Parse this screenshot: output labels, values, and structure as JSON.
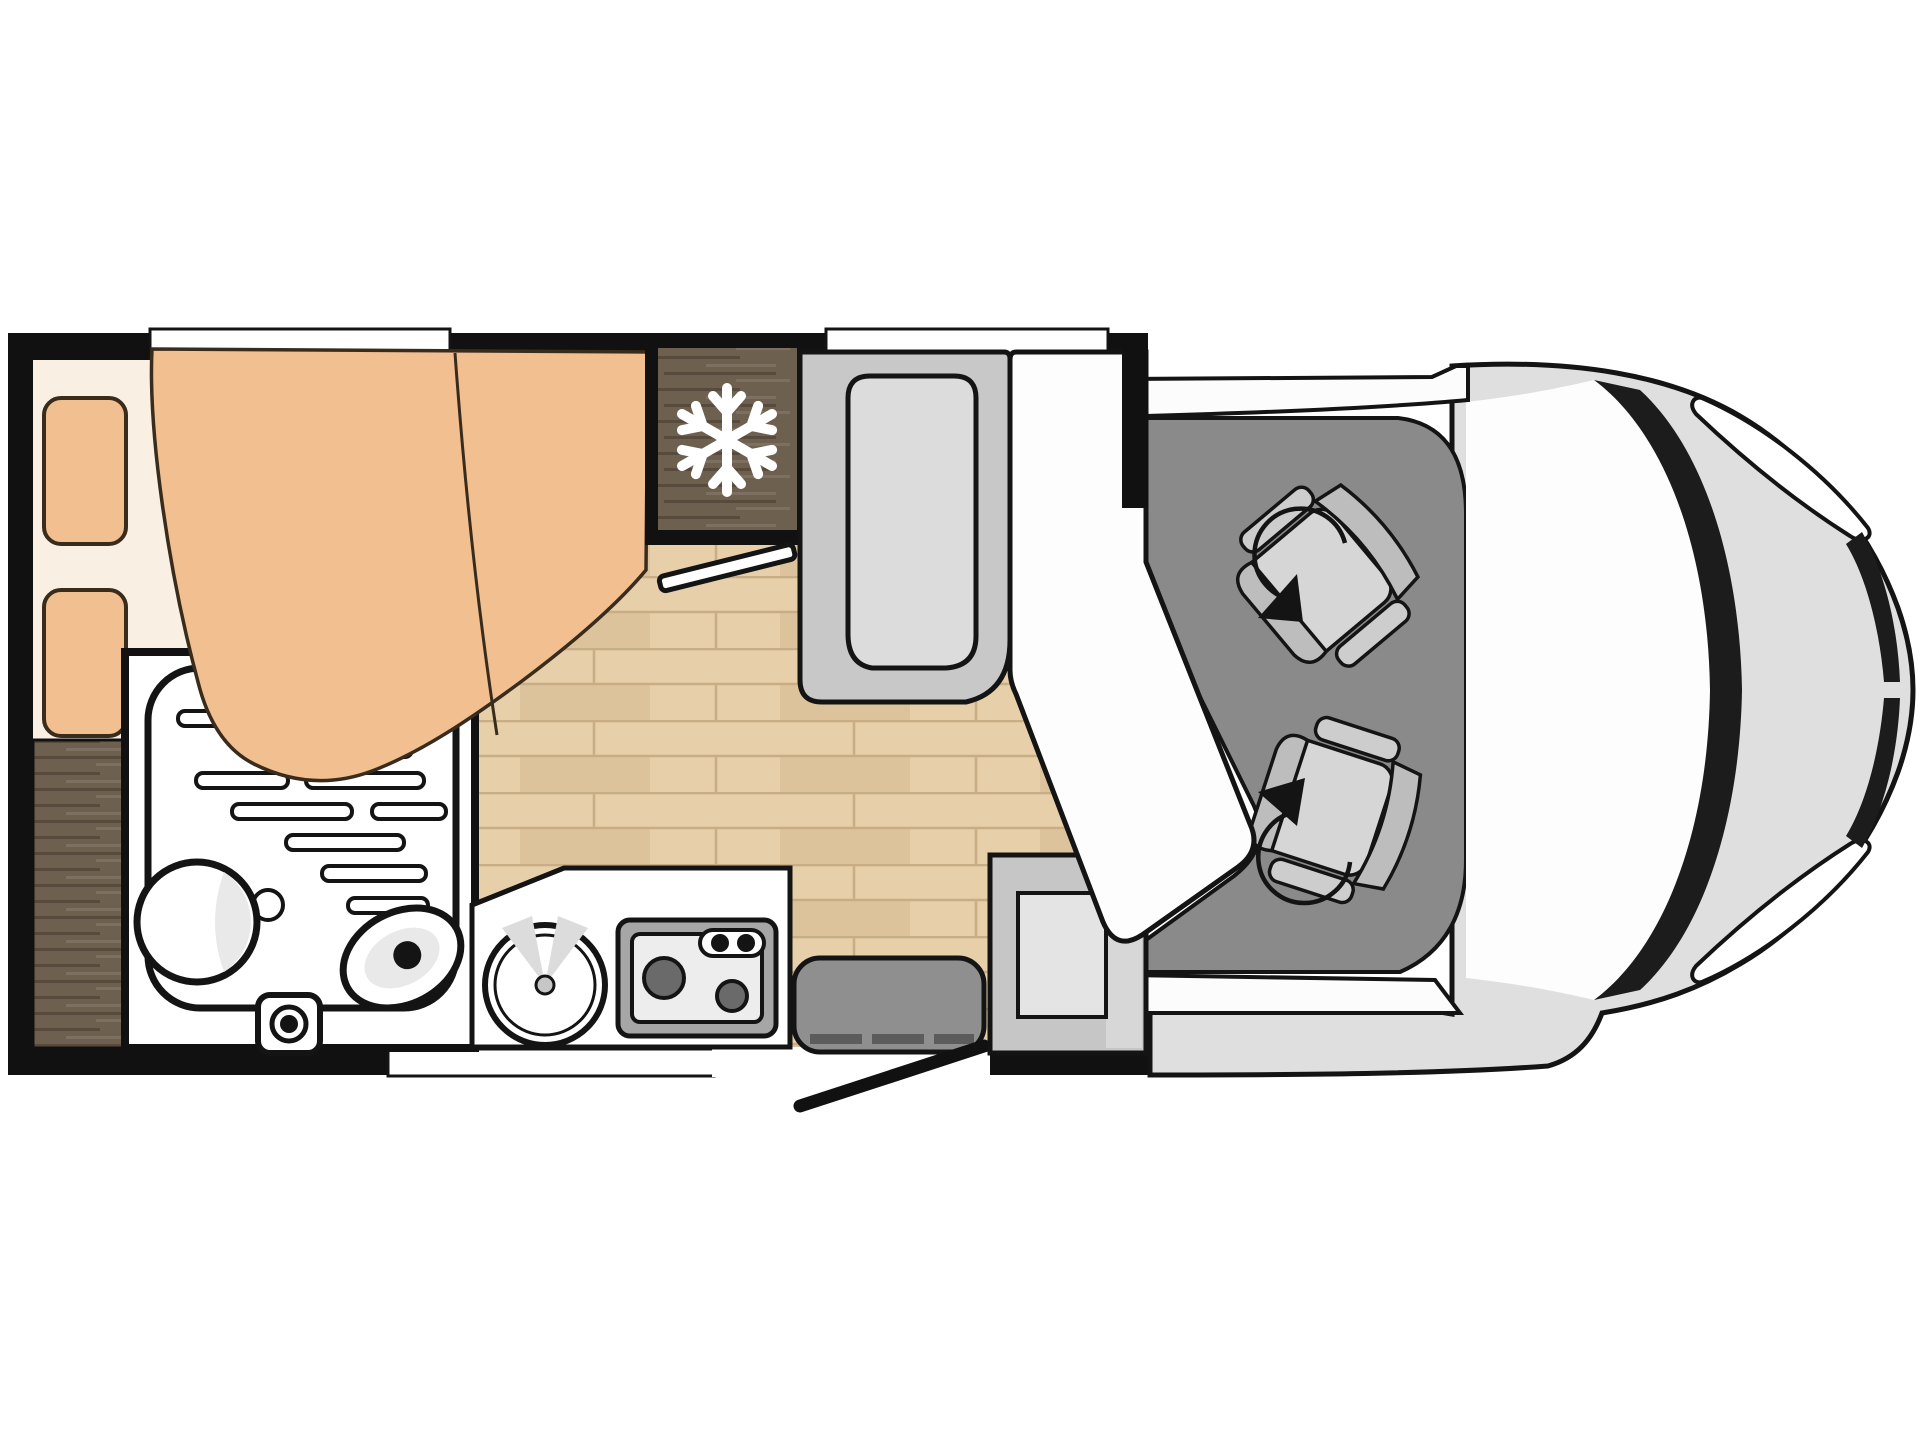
{
  "document": {
    "kind": "motorhome-floor-plan",
    "visible_text": [],
    "counts": {
      "pillows": 2,
      "swivel_seats": 2,
      "stove_burners": 2,
      "wall_windows": 3,
      "rotation_arrows": 2
    }
  },
  "icons": {
    "snowflake": {
      "name": "snowflake-icon",
      "color": "#ffffff",
      "meaning_shape": "6-armed snowflake on fridge"
    },
    "rotation_arrow": {
      "name": "rotation-arrow-icon",
      "color": "#1a1a1a",
      "meaning_shape": "circular arc with arrowhead on each cab seat"
    }
  },
  "colors": {
    "c-outline": "#141414",
    "c-wall": "#111111",
    "c-page": "#ffffff",
    "c-wood": "#e6cfa9",
    "c-wood-line": "#c9ae85",
    "c-wood-dark": "#dcc39b",
    "c-darkwood": "#6e604f",
    "c-darkwood-dk": "#584a3c",
    "c-darkwood-lt": "#7e7060",
    "c-bedbase": "#f9f0e3",
    "c-peach": "#f2bf90",
    "c-peach-line": "#3a2c1d",
    "c-room": "#ffffff",
    "c-bench": "#c8c8c8",
    "c-cushion": "#dcdcdc",
    "c-cabfloor": "#8a8a8a",
    "c-seat": "#cdcdcd",
    "c-seat-band": "#bdbdbd",
    "c-seat-cushion": "#d6d6d6",
    "c-body": "#dfdfdf",
    "c-band": "#fcfcfc",
    "c-windshield": "#fdfdfd",
    "c-pillar": "#1c1c1c",
    "c-table": "#fdfdfd",
    "c-cabinet": "#c6c6c6",
    "c-cabinet-panel": "#e4e4e4",
    "c-cabinet-band": "#d7d7d7",
    "c-step": "#8f8f8f",
    "c-step-tick": "#5c5c5c",
    "c-stove": "#a6a6a6",
    "c-stove-panel": "#ededed",
    "c-burner": "#6a6a6a",
    "c-fixture-shade": "#e9e9e9",
    "c-snow": "#ffffff"
  },
  "features": [
    "double-bed",
    "pillows",
    "duvet",
    "wardrobe",
    "bathroom",
    "shower-tray",
    "washbasin",
    "sink",
    "toilet",
    "fridge",
    "interior-door",
    "wood-floor",
    "dinette-bench",
    "table",
    "kitchen-counter",
    "kitchen-sink",
    "stove",
    "entry-step",
    "entry-door",
    "cab-floor",
    "driver-swivel-seat",
    "passenger-swivel-seat",
    "vehicle-body",
    "windshield",
    "headlights"
  ]
}
